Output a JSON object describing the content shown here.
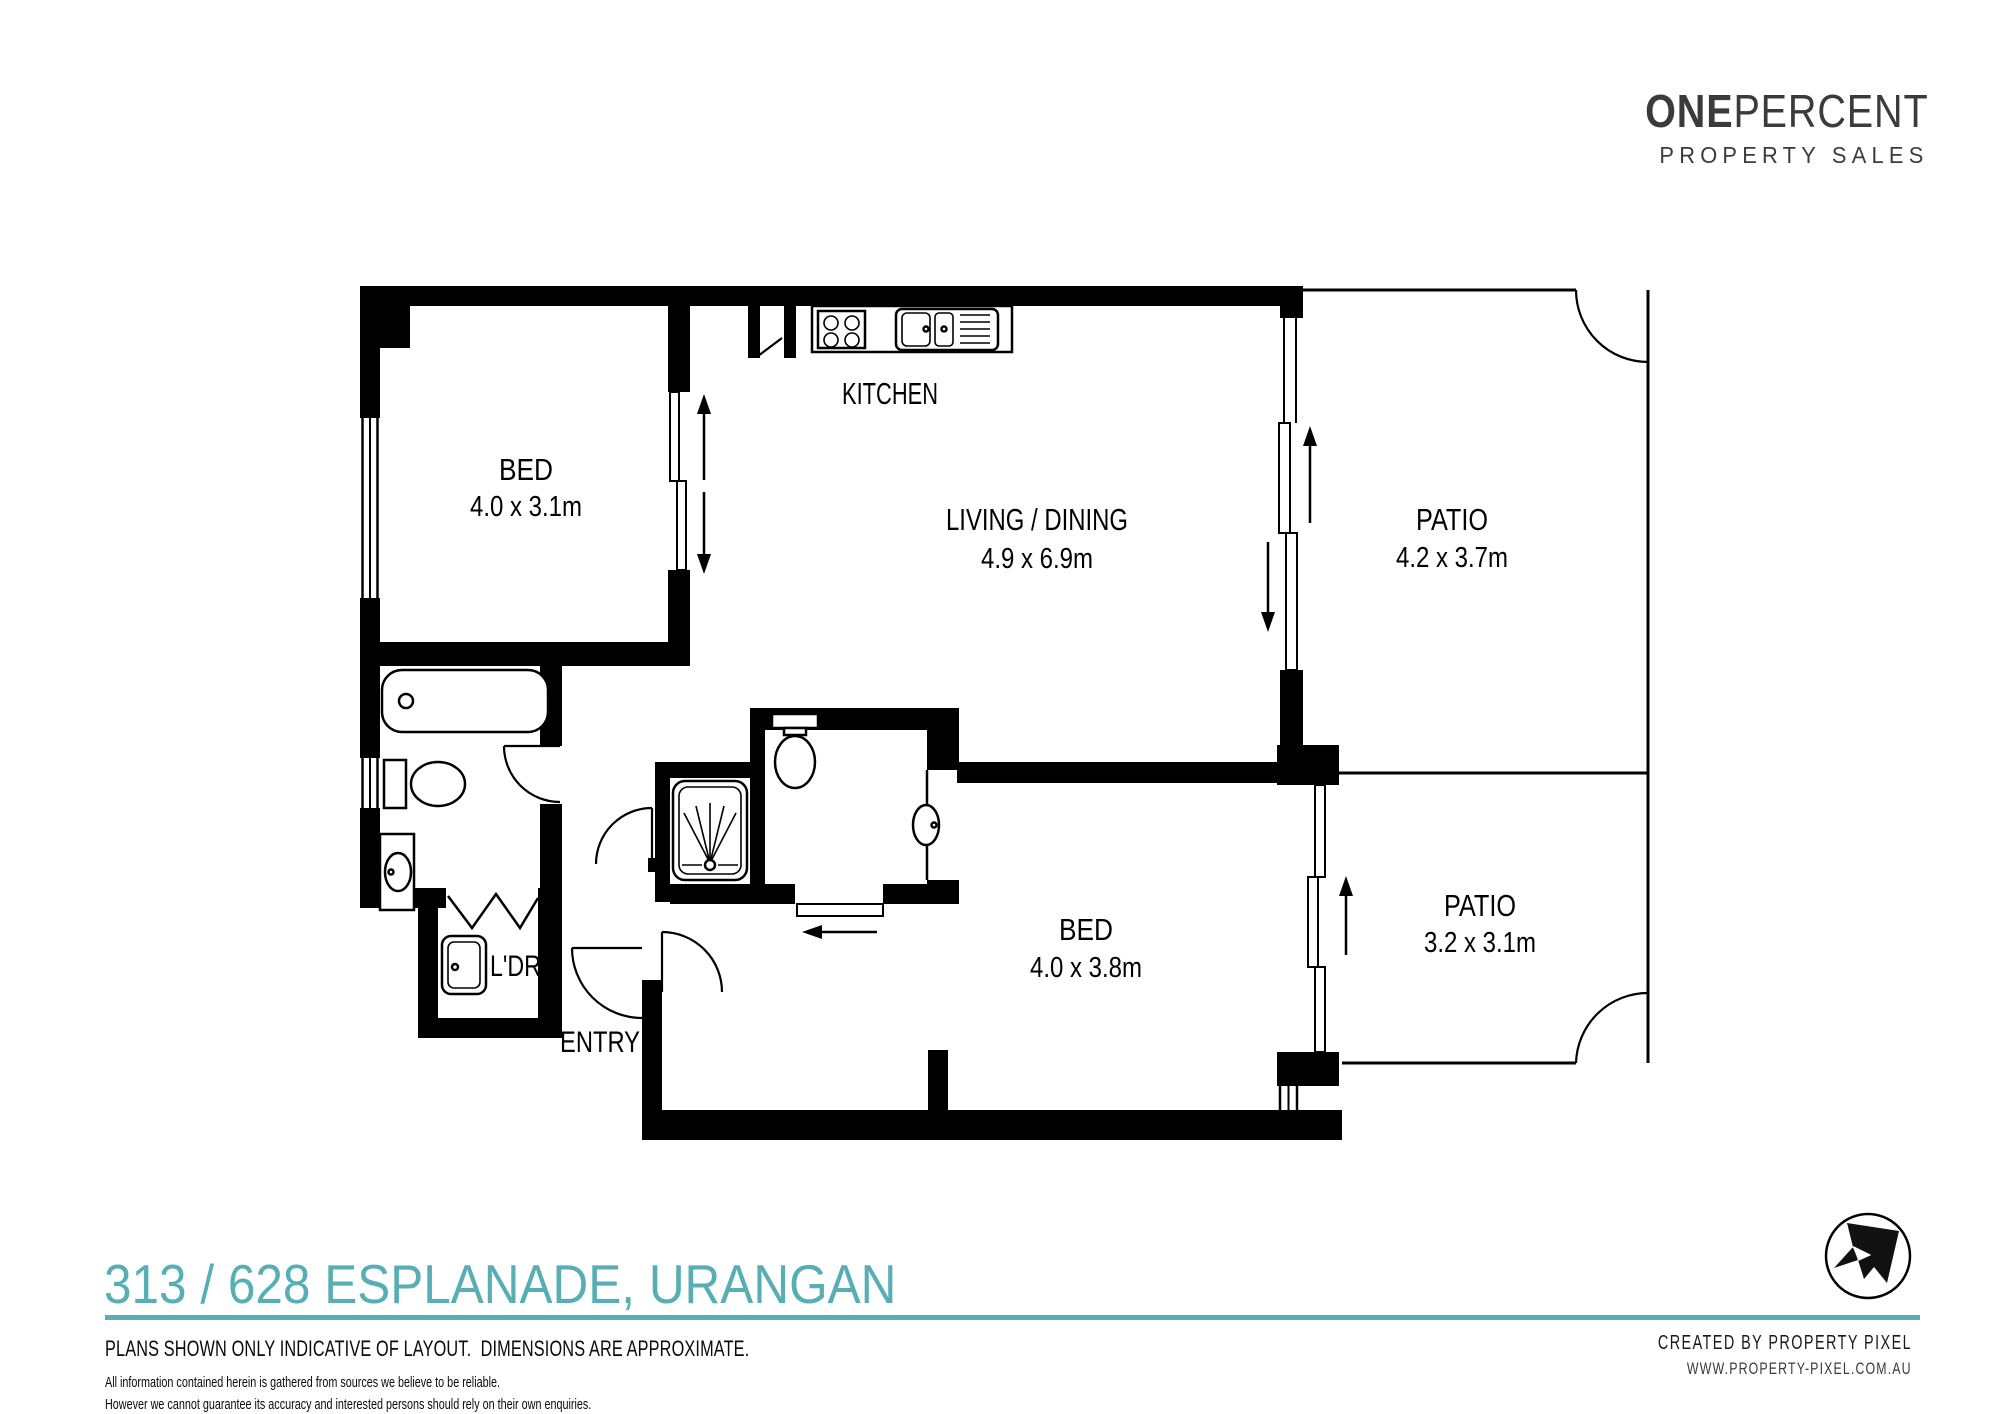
{
  "branding": {
    "agency_name_bold": "ONE",
    "agency_name_light": "PERCENT",
    "agency_tagline": "PROPERTY SALES"
  },
  "floorplan": {
    "rooms": {
      "bed1": {
        "name": "BED",
        "dims": "4.0 x 3.1m"
      },
      "kitchen": {
        "name": "KITCHEN"
      },
      "living": {
        "name": "LIVING / DINING",
        "dims": "4.9 x 6.9m"
      },
      "patio1": {
        "name": "PATIO",
        "dims": "4.2 x 3.7m"
      },
      "bed2": {
        "name": "BED",
        "dims": "4.0 x 3.8m"
      },
      "patio2": {
        "name": "PATIO",
        "dims": "3.2 x 3.1m"
      },
      "laundry": {
        "name": "L'DRY"
      },
      "entry": {
        "name": "ENTRY"
      }
    },
    "fixtures": [
      "bathtub",
      "toilet",
      "basin",
      "laundry-tub",
      "shower",
      "ensuite-toilet",
      "ensuite-basin",
      "cooktop",
      "double-sink"
    ]
  },
  "footer": {
    "address": "313 / 628 ESPLANADE, URANGAN",
    "disclaimer_primary": "PLANS SHOWN ONLY INDICATIVE OF LAYOUT.  DIMENSIONS ARE APPROXIMATE.",
    "disclaimer_line1": "All information contained herein is gathered from sources we believe to be reliable.",
    "disclaimer_line2": "However we cannot guarantee its accuracy and interested persons should rely on their own enquiries.",
    "credit_line1": "CREATED BY PROPERTY PIXEL",
    "credit_line2": "WWW.PROPERTY-PIXEL.COM.AU"
  },
  "colors": {
    "accent_teal": "#57AEB4",
    "ink": "#000000",
    "logo_charcoal": "#3B3B3D"
  }
}
